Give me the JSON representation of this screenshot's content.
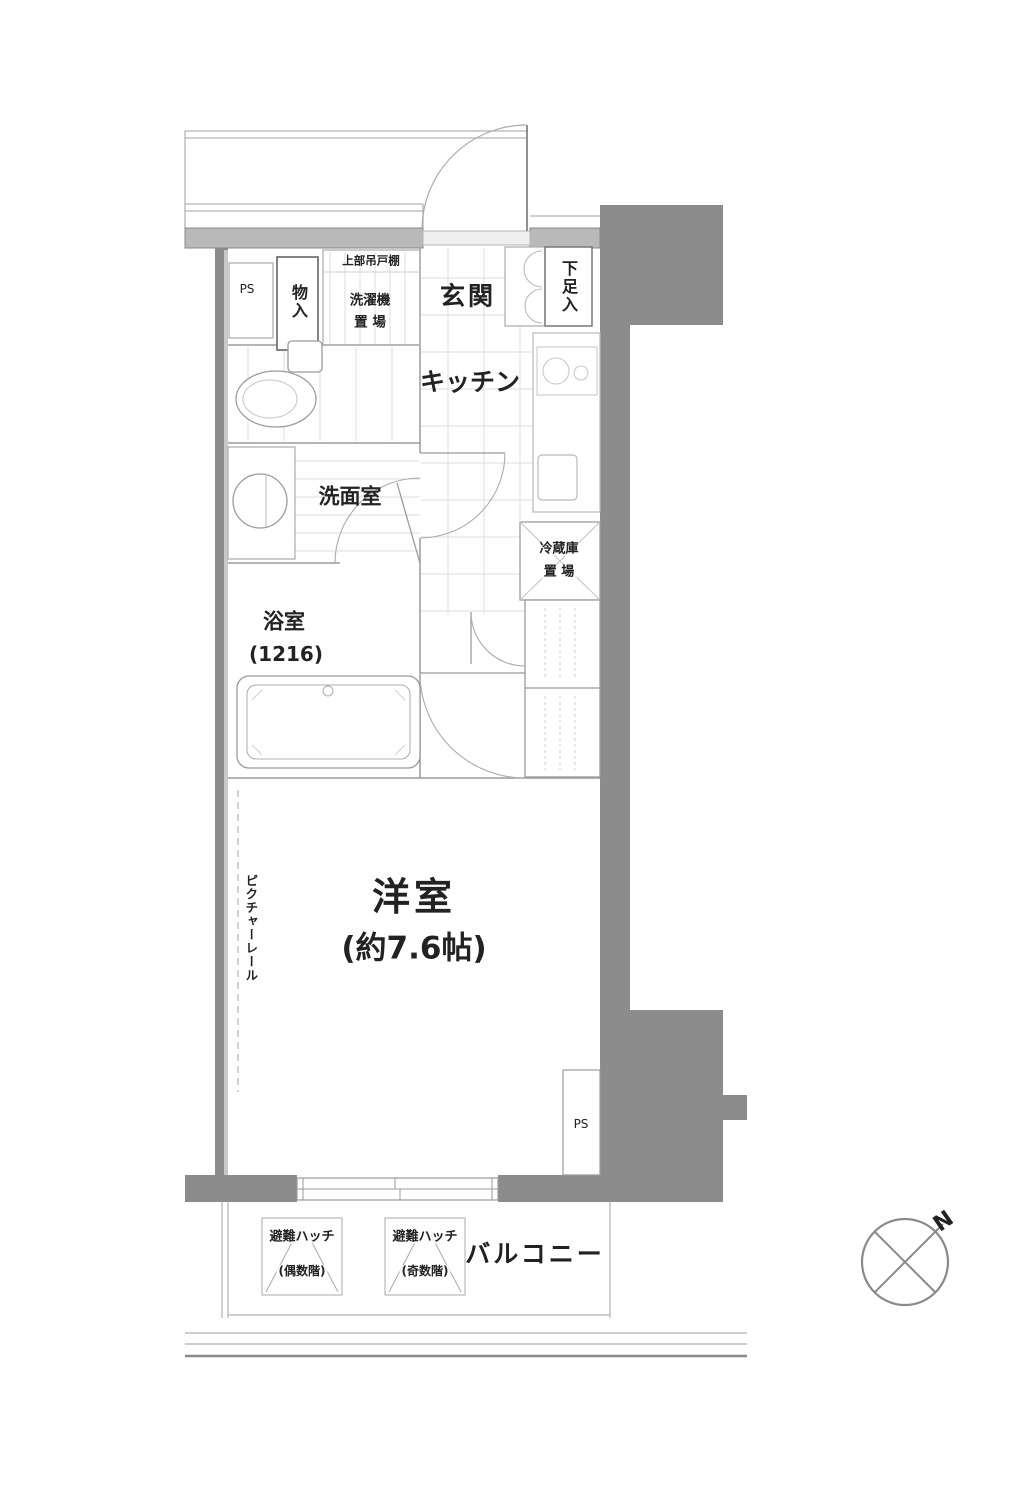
{
  "plan_title": "1K apartment floor plan",
  "colors": {
    "wall": "#8c8c8c",
    "wall_light": "#b9b9b9",
    "line": "#9b9b9b",
    "grid": "#d8d8d8",
    "text": "#222222"
  },
  "rooms": {
    "genkan": "玄関",
    "kitchen": "キッチン",
    "washroom": "洗面室",
    "bath_line1": "浴室",
    "bath_line2": "(1216)",
    "main_line1": "洋室",
    "main_line2": "(約7.6帖)",
    "balcony": "バルコニー"
  },
  "fixtures": {
    "ps_top": "PS",
    "ps_bottom": "PS",
    "storage": "物入",
    "upper_cabinet": "上部吊戸棚",
    "washer_line1": "洗濯機",
    "washer_line2": "置 場",
    "shoe_box": "下足入",
    "fridge_line1": "冷蔵庫",
    "fridge_line2": "置 場",
    "picture_rail": "ピクチャーレール",
    "hatch_label": "避難ハッチ",
    "hatch_even": "(偶数階)",
    "hatch_odd": "(奇数階)"
  },
  "compass": {
    "north": "N"
  }
}
